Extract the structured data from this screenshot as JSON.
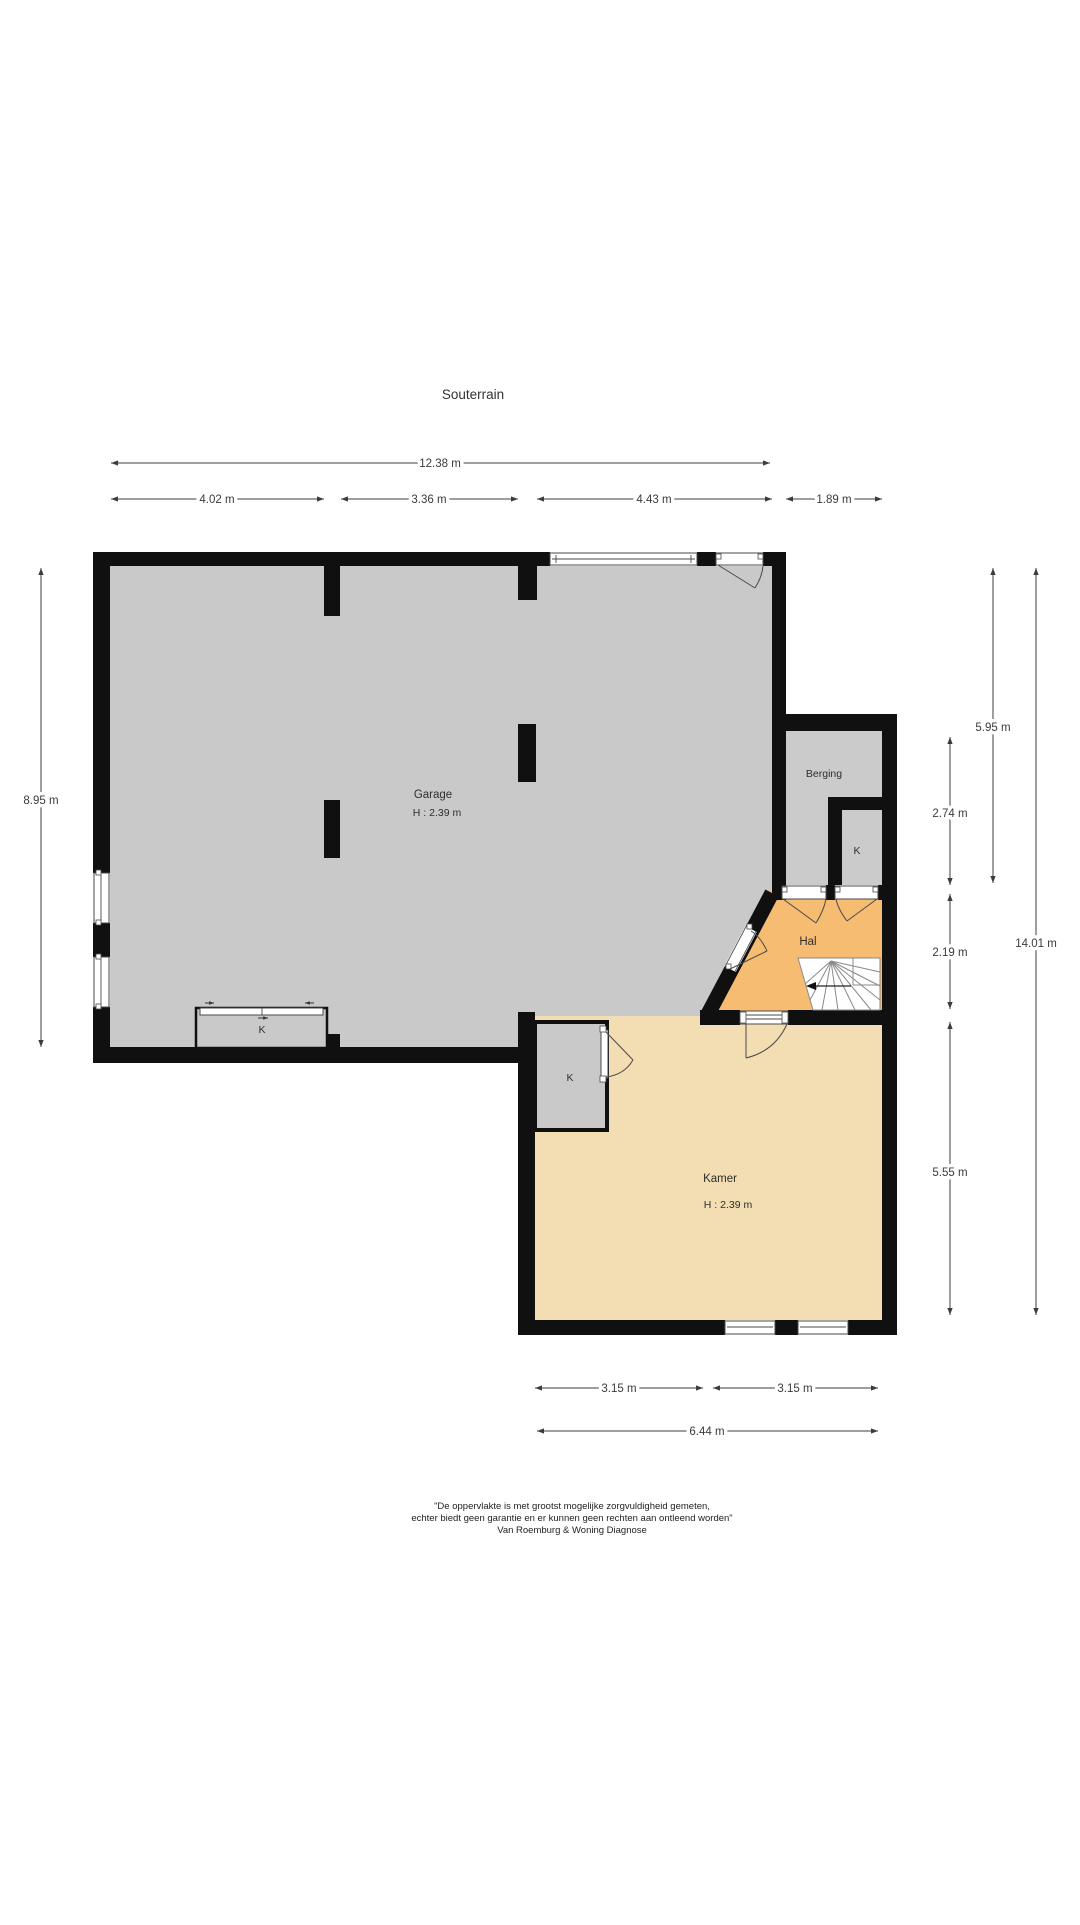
{
  "title": "Souterrain",
  "colors": {
    "wall": "#101010",
    "garage_floor": "#c9c9c9",
    "berging_floor": "#cbcbcb",
    "hal_floor": "#f6bc72",
    "kamer_floor": "#f3ddb3",
    "closet_floor": "#c9c9c9",
    "dimension_line": "#3c3c3c"
  },
  "rooms": {
    "garage": {
      "name": "Garage",
      "height": "H : 2.39 m"
    },
    "berging": {
      "name": "Berging"
    },
    "berging_closet": {
      "name": "K"
    },
    "hal": {
      "name": "Hal"
    },
    "garage_closet": {
      "name": "K"
    },
    "kamer_closet": {
      "name": "K"
    },
    "kamer": {
      "name": "Kamer",
      "height": "H : 2.39 m"
    }
  },
  "dimensions": {
    "top_total": "12.38 m",
    "top_segments": [
      "4.02 m",
      "3.36 m",
      "4.43 m",
      "1.89 m"
    ],
    "left_total": "8.95 m",
    "right_upper": "5.95 m",
    "right_berging": "2.74 m",
    "right_hal": "2.19 m",
    "right_kamer": "5.55 m",
    "right_total": "14.01 m",
    "bottom_segments": [
      "3.15 m",
      "3.15 m"
    ],
    "bottom_total": "6.44 m"
  },
  "disclaimer": {
    "line1": "\"De oppervlakte is met grootst mogelijke zorgvuldigheid gemeten,",
    "line2": "echter biedt geen garantie en er kunnen geen rechten aan ontleend worden\"",
    "line3": "Van Roemburg & Woning Diagnose"
  }
}
